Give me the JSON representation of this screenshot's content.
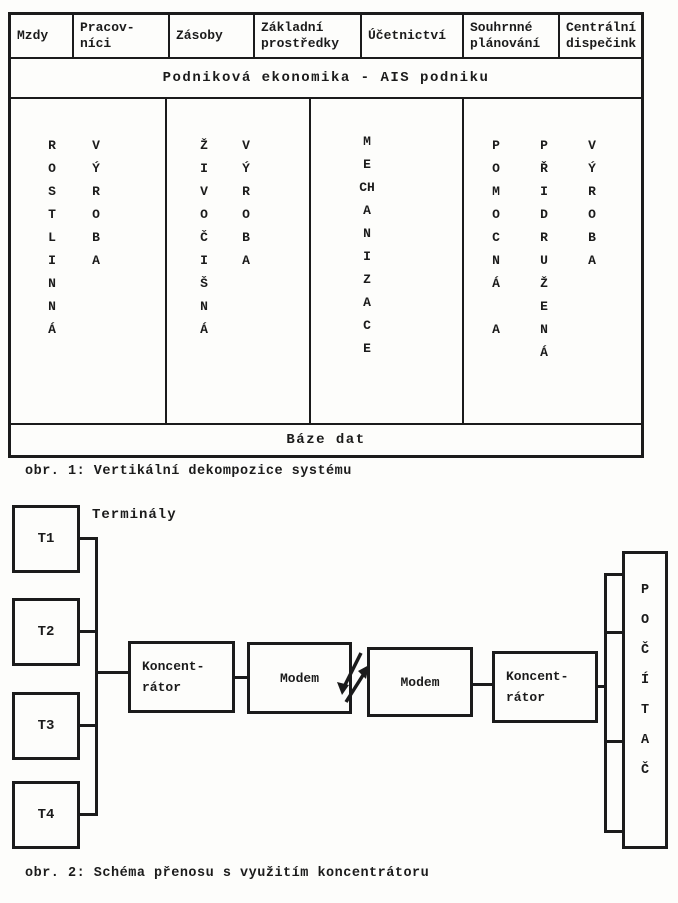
{
  "colors": {
    "ink": "#1b1b1b",
    "paper": "#fdfdfb"
  },
  "figure1": {
    "caption": "obr. 1: Vertikální dekompozice systému",
    "headers": [
      [
        "Mzdy"
      ],
      [
        "Pracov-",
        "níci"
      ],
      [
        "Zásoby"
      ],
      [
        "Základní",
        "prostředky"
      ],
      [
        "Účetnictví"
      ],
      [
        "Souhrnné",
        "plánování"
      ],
      [
        "Centrální",
        "dispečink"
      ]
    ],
    "banner": "Podniková ekonomika - AIS podniku",
    "base_band": "Báze dat",
    "columns": [
      [
        [
          "R",
          "O",
          "S",
          "T",
          "L",
          "I",
          "N",
          "N",
          "Á"
        ],
        [
          "V",
          "Ý",
          "R",
          "O",
          "B",
          "A"
        ]
      ],
      [
        [
          "Ž",
          "I",
          "V",
          "O",
          "Č",
          "I",
          "Š",
          "N",
          "Á"
        ],
        [
          "V",
          "Ý",
          "R",
          "O",
          "B",
          "A"
        ]
      ],
      [
        [
          "M",
          "E",
          "CH",
          "A",
          "N",
          "I",
          "Z",
          "A",
          "C",
          "E"
        ]
      ],
      [
        [
          "P",
          "O",
          "M",
          "O",
          "C",
          "N",
          "Á",
          "",
          "A"
        ],
        [
          "P",
          "Ř",
          "I",
          "D",
          "R",
          "U",
          "Ž",
          "E",
          "N",
          "Á"
        ],
        [
          "V",
          "Ý",
          "R",
          "O",
          "B",
          "A"
        ]
      ]
    ]
  },
  "figure2": {
    "caption": "obr. 2: Schéma přenosu s využitím koncentrátoru",
    "terminals_label": "Terminály",
    "terminals": [
      "T1",
      "T2",
      "T3",
      "T4"
    ],
    "concentrator_left": [
      "Koncent-",
      "rátor"
    ],
    "modem_left": "Modem",
    "modem_right": "Modem",
    "concentrator_right": [
      "Koncent-",
      "rátor"
    ],
    "computer_letters": [
      "P",
      "O",
      "Č",
      "Í",
      "T",
      "A",
      "Č"
    ]
  }
}
